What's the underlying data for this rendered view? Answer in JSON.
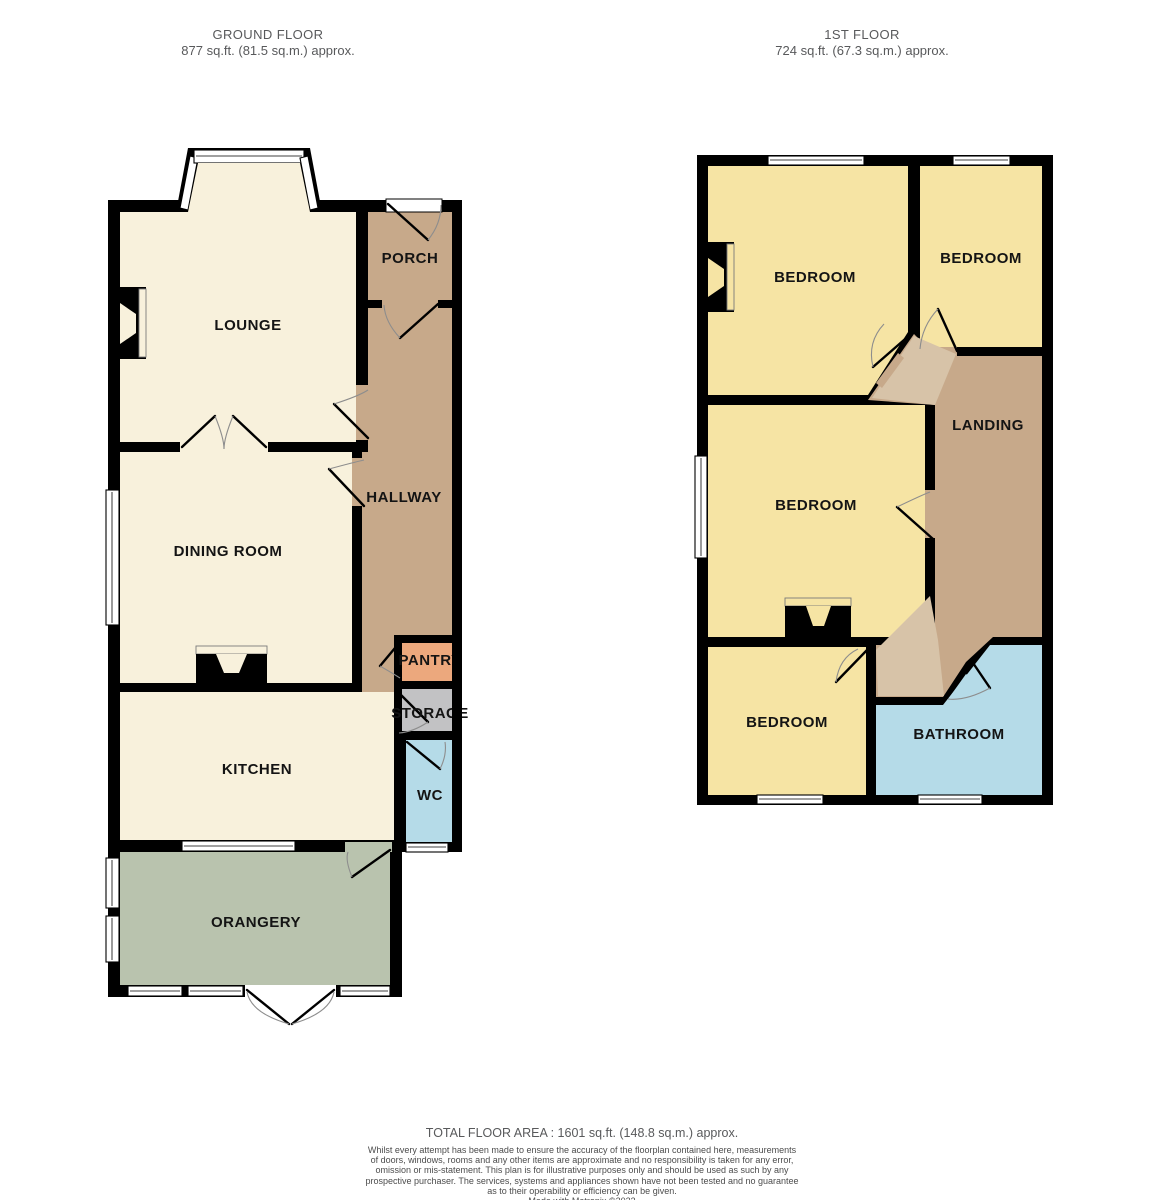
{
  "headers": {
    "ground": {
      "title": "GROUND FLOOR",
      "area": "877 sq.ft. (81.5 sq.m.) approx."
    },
    "first": {
      "title": "1ST FLOOR",
      "area": "724 sq.ft. (67.3 sq.m.) approx."
    }
  },
  "rooms": {
    "ground": {
      "lounge": "LOUNGE",
      "porch": "PORCH",
      "hallway": "HALLWAY",
      "dining": "DINING ROOM",
      "pantry": "PANTRY",
      "storage": "STORAGE",
      "kitchen": "KITCHEN",
      "wc": "WC",
      "orangery": "ORANGERY"
    },
    "first": {
      "bedroom1": "BEDROOM",
      "bedroom2": "BEDROOM",
      "landing": "LANDING",
      "bedroom3": "BEDROOM",
      "bedroom4": "BEDROOM",
      "bathroom": "BATHROOM"
    }
  },
  "footer": {
    "total": "TOTAL FLOOR AREA : 1601 sq.ft. (148.8 sq.m.) approx.",
    "disclaimer_lines": [
      "Whilst every attempt has been made to ensure the accuracy of the floorplan contained here, measurements",
      "of doors, windows, rooms and any other items are approximate and no responsibility is taken for any error,",
      "omission or mis-statement. This plan is for illustrative purposes only and should be used as such by any",
      "prospective purchaser. The services, systems and appliances shown have not been tested and no guarantee",
      "as to their operability or efficiency can be given.",
      "Made with Metropix ©2023"
    ]
  },
  "colors": {
    "cream": "#F8F1DC",
    "yellow": "#F6E4A4",
    "brown": "#C7A98A",
    "brown_light": "#D7C3A8",
    "sage": "#B9C3AE",
    "blue": "#B5DBE8",
    "orange": "#ECA87D",
    "gray": "#C2C2C4",
    "wall": "#000000",
    "header_text": "#58595B",
    "label_text": "#141414"
  }
}
